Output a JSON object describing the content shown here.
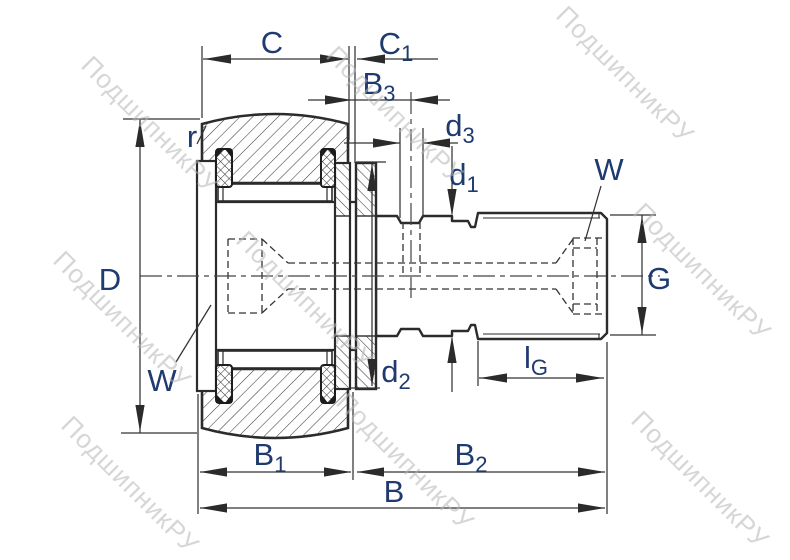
{
  "labels": {
    "C": {
      "main": "C",
      "sub": ""
    },
    "C1": {
      "main": "C",
      "sub": "1"
    },
    "B3": {
      "main": "B",
      "sub": "3"
    },
    "d3": {
      "main": "d",
      "sub": "3"
    },
    "d1": {
      "main": "d",
      "sub": "1"
    },
    "d2": {
      "main": "d",
      "sub": "2"
    },
    "W_right": {
      "main": "W",
      "sub": ""
    },
    "W_left": {
      "main": "W",
      "sub": ""
    },
    "r": {
      "main": "r",
      "sub": ""
    },
    "D": {
      "main": "D",
      "sub": ""
    },
    "G": {
      "main": "G",
      "sub": ""
    },
    "lG": {
      "main": "l",
      "sub": "G"
    },
    "B1": {
      "main": "B",
      "sub": "1"
    },
    "B2": {
      "main": "B",
      "sub": "2"
    },
    "B": {
      "main": "B",
      "sub": ""
    }
  },
  "watermark": {
    "text": "ПодшипникРУ",
    "color": "#b5b5b5"
  },
  "colors": {
    "line": "#2b2b2b",
    "thin_line": "#3a3a3a",
    "label": "#1e3a6e",
    "background": "#ffffff"
  }
}
